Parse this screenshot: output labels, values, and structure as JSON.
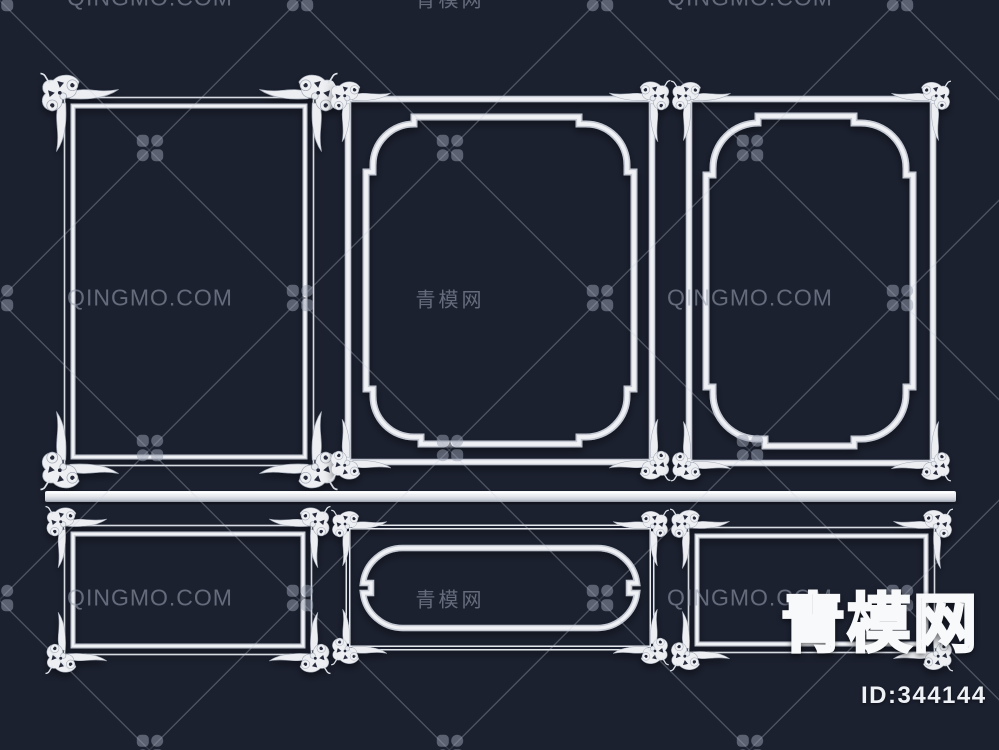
{
  "canvas": {
    "width": 999,
    "height": 750,
    "background_color": "#1c2130"
  },
  "watermark": {
    "text_en": "QINGMO.COM",
    "text_zh": "青模网",
    "color": "#9aa1b2"
  },
  "brand": {
    "logo_text": "青模网",
    "id_text": "ID:344144",
    "text_color": "#f2f4f8"
  },
  "render": {
    "molding_color": "#eef0f4",
    "frames": [
      {
        "name": "ornate-rect-frame-large",
        "row": "top",
        "position": "left"
      },
      {
        "name": "ornate-notched-panel-frame",
        "row": "top",
        "position": "center"
      },
      {
        "name": "ornate-notched-panel-frame",
        "row": "top",
        "position": "right"
      },
      {
        "name": "ornate-rect-frame-small",
        "row": "bottom",
        "position": "left"
      },
      {
        "name": "ornate-stadium-panel-frame",
        "row": "bottom",
        "position": "center"
      },
      {
        "name": "ornate-rect-frame-small",
        "row": "bottom",
        "position": "right"
      },
      {
        "name": "dado-rail-molding",
        "row": "middle",
        "position": "full-width"
      }
    ]
  }
}
